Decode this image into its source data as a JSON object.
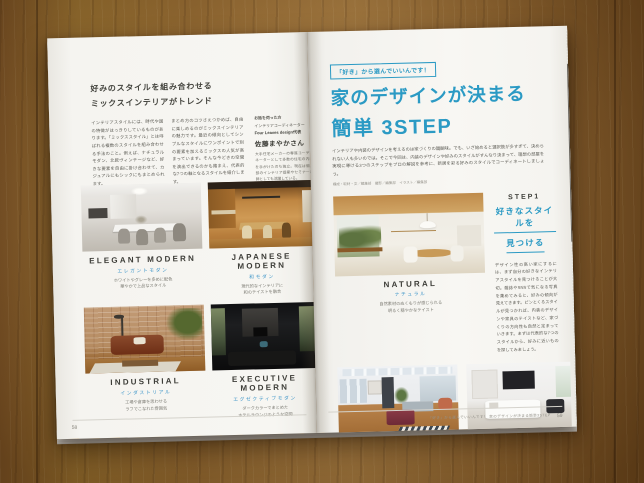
{
  "colors": {
    "accent_blue": "#2b9ac4",
    "label_blue": "#3f96c9",
    "ink": "#44443e",
    "wood": "#9c6c2e"
  },
  "left_page": {
    "page_number": "58",
    "headline_line1": "好みのスタイルを組み合わせる",
    "headline_line2": "ミックスインテリアがトレンド",
    "body_col1": "インテリアスタイルには、時代や国の特徴がはっきりしているものがあります。「ミックススタイル」とは呼ばれる複数のスタイルを組み合わせる手法のこと。例えば、ナチュラルモダン、北欧ヴィンテージなど、好きな要素を自由に掛け合わせて、カジュアルにもシックにもまとめられます。",
    "body_col2": "まとめ方のコツさえつかめば、自由に楽しめるのがミックスインテリアの魅力です。最近の傾向としてシンプルなスタイルにワンポイントで別の要素を加えるミックスの人気が高まっています。そんな今どきの空間を演出できるのかも踏まえ、代表的な7つの軸となるスタイルを紹介します。",
    "credit": {
      "note": "お話を伺った方",
      "role": "インテリアコーディネーター",
      "org": "Four Leaves design代表",
      "name": "佐藤まやかさん",
      "bio": "大手住宅メーカーの専属コーディネーターとして多数の住宅の内装を手がけたのち独立。現在は個人邸のインテリア提案やセミナー講師としても活躍している。"
    },
    "styles": [
      {
        "en": "ELEGANT MODERN",
        "ja": "エレガントモダン",
        "desc1": "ホワイトやグレーを多めに配色",
        "desc2": "華やかで上品なスタイル"
      },
      {
        "en": "JAPANESE MODERN",
        "ja": "和モダン",
        "desc1": "現代的なインテリアに",
        "desc2": "和のテイストを融合"
      },
      {
        "en": "INDUSTRIAL",
        "ja": "インダストリアル",
        "desc1": "工場や倉庫を思わせる",
        "desc2": "ラフでこなれた雰囲気"
      },
      {
        "en": "EXECUTIVE MODERN",
        "ja": "エグゼクティブモダン",
        "desc1": "ダークカラーでまとめた",
        "desc2": "ホテルラウンジのような空間"
      }
    ]
  },
  "right_page": {
    "page_number": "59",
    "tagline": "「好き」から選んでいいんです！",
    "title_line1": "家のデザインが決まる",
    "title_line2": "簡単 3STEP",
    "intro": "インテリアや内装のデザインを考えるのは家づくりの醍醐味。でも、いざ始めると選択肢が多すぎて、決められない人も多いのでは。そこで今回は、内装のデザインや好みのスタイルがすんなり決まって、理想の部屋を実現に導ける3つのステップをプロの解説を参考に、新居を彩る好みのスタイルでコーディネートしましょう。",
    "credits": "構成・取材・文／編集部　撮影／編集部　イラスト／編集部",
    "step1": {
      "label": "STEP1",
      "title_line1": "好きなスタイルを",
      "title_line2": "見つける",
      "body": "デザイン性の高い家にするには、まず自分の好きなインテリアスタイルを見つけることが大切。雑誌やSNSで気になる写真を集めてみると、好みの傾向が見えてきます。ピンとくるスタイルが見つかれば、内装のデザインや家具のテイストなど、家づくりの方向性も自然と定まっていきます。まずは代表的な7つのスタイルから、好みに近いものを探してみましょう。"
    },
    "styles": [
      {
        "en": "NATURAL",
        "ja": "ナチュラル",
        "desc1": "自然素材のぬくもりが感じられる",
        "desc2": "明るく穏やかなテイスト"
      },
      {
        "en": "NORDIC",
        "ja": "北欧",
        "desc1": "大胆な模様や色使いも楽しめる",
        "desc2": "アレンジ自在なスタイル"
      },
      {
        "en": "SIMPLE MODERN",
        "ja": "シンプルモダン",
        "desc1": "モノトーンカラーで統一",
        "desc2": "機能を兼ねたシンプルなデザイン"
      }
    ],
    "footer": "「好き」から選んでいいんです！ 家のデザインが決まる簡単3STEP"
  }
}
